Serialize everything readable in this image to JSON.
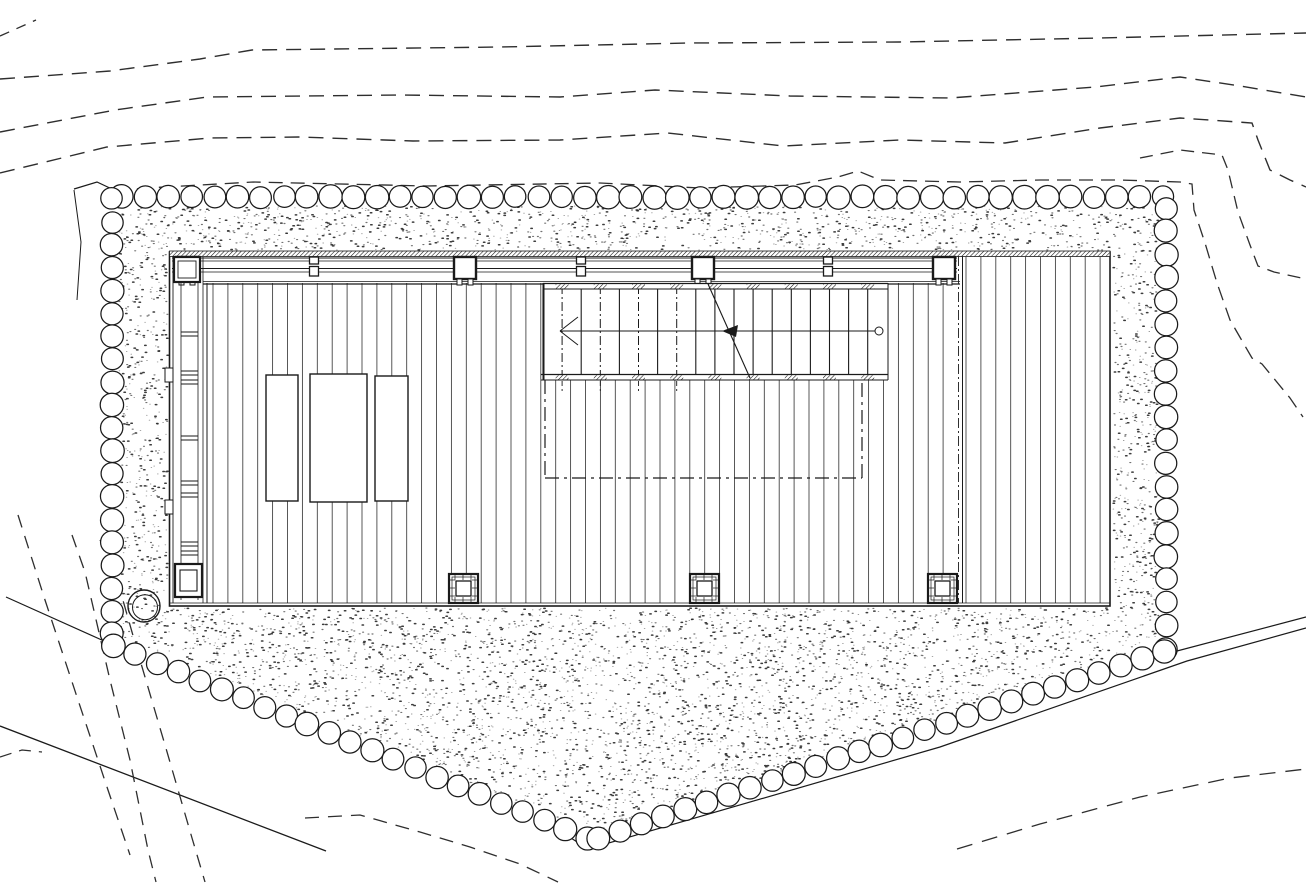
{
  "canvas": {
    "width": 1306,
    "height": 889,
    "background": "#ffffff"
  },
  "palette": {
    "ink": "#1a1a1a",
    "plank": "#3a3a3a",
    "dash": "#2e2e2e",
    "dot": "#1b1b1b"
  },
  "site": {
    "contour_lines_dashed": [
      {
        "name": "contour-top-corner",
        "dash": "10 8",
        "width": 1.3,
        "points": [
          [
            0,
            36
          ],
          [
            36,
            20
          ]
        ]
      },
      {
        "name": "contour-1",
        "dash": "15 9",
        "width": 1.4,
        "points": [
          [
            0,
            79
          ],
          [
            110,
            71
          ],
          [
            200,
            59
          ],
          [
            252,
            50
          ],
          [
            500,
            47
          ],
          [
            690,
            43
          ],
          [
            900,
            42
          ],
          [
            1100,
            38
          ],
          [
            1306,
            33
          ]
        ]
      },
      {
        "name": "contour-2",
        "dash": "15 9",
        "width": 1.4,
        "points": [
          [
            0,
            132
          ],
          [
            115,
            110
          ],
          [
            207,
            97
          ],
          [
            400,
            95
          ],
          [
            560,
            97
          ],
          [
            655,
            90
          ],
          [
            790,
            96
          ],
          [
            950,
            98
          ],
          [
            1095,
            87
          ],
          [
            1180,
            77
          ],
          [
            1240,
            86
          ],
          [
            1306,
            97
          ]
        ]
      },
      {
        "name": "contour-3",
        "dash": "15 9",
        "width": 1.4,
        "points": [
          [
            0,
            173
          ],
          [
            107,
            147
          ],
          [
            210,
            138
          ],
          [
            300,
            137
          ],
          [
            413,
            141
          ],
          [
            560,
            140
          ],
          [
            668,
            133
          ],
          [
            783,
            146
          ],
          [
            900,
            140
          ],
          [
            1005,
            143
          ],
          [
            1100,
            128
          ],
          [
            1180,
            118
          ],
          [
            1252,
            123
          ],
          [
            1258,
            140
          ],
          [
            1270,
            170
          ],
          [
            1290,
            180
          ],
          [
            1306,
            187
          ]
        ]
      },
      {
        "name": "contour-4-gravel-edge",
        "dash": "14 8",
        "width": 1.3,
        "points": [
          [
            115,
            191
          ],
          [
            147,
            188
          ],
          [
            253,
            182
          ],
          [
            427,
            186
          ],
          [
            600,
            183
          ],
          [
            700,
            188
          ],
          [
            795,
            185
          ],
          [
            838,
            177
          ],
          [
            858,
            171
          ],
          [
            880,
            180
          ],
          [
            960,
            182
          ],
          [
            1040,
            180
          ],
          [
            1120,
            180
          ],
          [
            1180,
            182
          ],
          [
            1192,
            184
          ],
          [
            1194,
            210
          ],
          [
            1205,
            243
          ],
          [
            1217,
            283
          ],
          [
            1230,
            320
          ],
          [
            1252,
            358
          ],
          [
            1262,
            364
          ],
          [
            1290,
            398
          ],
          [
            1303,
            417
          ]
        ]
      },
      {
        "name": "contour-5-right-slope",
        "dash": "13 8",
        "width": 1.3,
        "points": [
          [
            1140,
            158
          ],
          [
            1180,
            150
          ],
          [
            1222,
            155
          ],
          [
            1228,
            170
          ],
          [
            1238,
            212
          ],
          [
            1250,
            245
          ],
          [
            1258,
            266
          ],
          [
            1274,
            272
          ],
          [
            1306,
            279
          ]
        ]
      },
      {
        "name": "contour-steep-1",
        "dash": "13 9",
        "width": 1.3,
        "points": [
          [
            18,
            515
          ],
          [
            45,
            600
          ],
          [
            78,
            700
          ],
          [
            108,
            790
          ],
          [
            130,
            855
          ]
        ]
      },
      {
        "name": "contour-steep-2",
        "dash": "13 9",
        "width": 1.3,
        "points": [
          [
            72,
            535
          ],
          [
            85,
            572
          ],
          [
            110,
            680
          ],
          [
            130,
            760
          ],
          [
            148,
            850
          ],
          [
            156,
            882
          ]
        ]
      },
      {
        "name": "contour-steep-3",
        "dash": "13 9",
        "width": 1.3,
        "points": [
          [
            100,
            540
          ],
          [
            112,
            562
          ],
          [
            140,
            660
          ],
          [
            165,
            745
          ],
          [
            192,
            838
          ],
          [
            205,
            882
          ]
        ]
      },
      {
        "name": "contour-left-stub",
        "dash": "12 8",
        "width": 1.2,
        "points": [
          [
            0,
            757
          ],
          [
            22,
            750
          ],
          [
            42,
            752
          ]
        ]
      },
      {
        "name": "contour-bottom-arc",
        "dash": "14 9",
        "width": 1.3,
        "points": [
          [
            305,
            818
          ],
          [
            360,
            815
          ],
          [
            420,
            832
          ],
          [
            470,
            847
          ],
          [
            520,
            864
          ],
          [
            558,
            882
          ]
        ]
      },
      {
        "name": "contour-bottom-right",
        "dash": "16 10",
        "width": 1.3,
        "points": [
          [
            957,
            849
          ],
          [
            1040,
            824
          ],
          [
            1140,
            797
          ],
          [
            1230,
            778
          ],
          [
            1306,
            769
          ]
        ]
      }
    ],
    "boundary_lines_solid": [
      {
        "name": "site-line-upper-left",
        "width": 1.2,
        "points": [
          [
            6,
            597
          ],
          [
            104,
            641
          ]
        ]
      },
      {
        "name": "site-line-lower-left",
        "width": 1.3,
        "points": [
          [
            0,
            726
          ],
          [
            326,
            851
          ]
        ]
      },
      {
        "name": "site-line-lower-right",
        "width": 1.2,
        "points": [
          [
            557,
            829
          ],
          [
            588,
            849
          ],
          [
            940,
            747
          ],
          [
            1187,
            661
          ],
          [
            1306,
            628
          ]
        ]
      },
      {
        "name": "site-line-far-right",
        "width": 1.2,
        "points": [
          [
            1158,
            656
          ],
          [
            1306,
            617
          ]
        ]
      },
      {
        "name": "gravel-corner-top-left",
        "width": 1.2,
        "points": [
          [
            74,
            189
          ],
          [
            97,
            182
          ],
          [
            114,
            190
          ]
        ]
      },
      {
        "name": "gravel-corner-descender",
        "width": 1.0,
        "points": [
          [
            74,
            190
          ],
          [
            81,
            242
          ],
          [
            77,
            300
          ]
        ]
      }
    ],
    "stone_border": {
      "radius": 11.2,
      "spacing": 23,
      "stroke_width": 1.25,
      "runs": [
        {
          "name": "stones-top",
          "points": [
            [
              122,
              197
            ],
            [
              1163,
              197
            ]
          ]
        },
        {
          "name": "stones-left",
          "points": [
            [
              112,
              199
            ],
            [
              112,
              634
            ]
          ]
        },
        {
          "name": "stones-right",
          "points": [
            [
              1166,
              208
            ],
            [
              1166,
              649
            ]
          ]
        },
        {
          "name": "stones-bottom-left",
          "points": [
            [
              114,
              646
            ],
            [
              587,
              838
            ]
          ]
        },
        {
          "name": "stones-bottom-right",
          "points": [
            [
              598,
              838
            ],
            [
              1164,
              651
            ]
          ]
        }
      ]
    },
    "gravel_area": {
      "stipple_polygon": [
        [
          116,
          206
        ],
        [
          1160,
          206
        ],
        [
          1160,
          647
        ],
        [
          590,
          834
        ],
        [
          116,
          634
        ]
      ],
      "stipple": {
        "seed": 42,
        "tries": 20000
      }
    },
    "well": {
      "cx": 144,
      "cy": 606,
      "r_outer": 16,
      "r_inner": 12.5
    }
  },
  "building": {
    "deck": {
      "x": 169.5,
      "y": 252,
      "width": 940.5,
      "height": 354,
      "wall_hatch_height": 5.5,
      "bottom_inner_line_y": 603,
      "section_solid_x": 962.5,
      "section_divider_x": 958.5
    },
    "beam": {
      "x1": 172,
      "x2": 957,
      "line_ys": [
        258,
        261,
        268.5,
        272
      ],
      "deck_edge_ys": [
        281.5,
        284
      ],
      "deck_edge_x1": 203,
      "deck_edge_x2": 960
    },
    "columns_large": {
      "y": 257,
      "size": 22,
      "centers_x": [
        187,
        465,
        703,
        944
      ]
    },
    "columns_small": {
      "centers_x": [
        314,
        581,
        828
      ]
    },
    "left_channel": {
      "wall_x": 173,
      "rail_x1": 181,
      "rail_x2": 198,
      "edge_x": 203,
      "deck_edge_x": 207,
      "rungs_y": [
        [
          277,
          281
        ],
        [
          332,
          336
        ],
        [
          371,
          375
        ],
        [
          380,
          384
        ],
        [
          436,
          440
        ],
        [
          481,
          485
        ],
        [
          493,
          497
        ],
        [
          542,
          546
        ],
        [
          551,
          555
        ],
        [
          576,
          580
        ]
      ],
      "tabs": [
        [
          165,
          368
        ],
        [
          165,
          500
        ]
      ],
      "top_plate": {
        "x": 174,
        "y": 257,
        "w": 26,
        "h": 25
      },
      "bottom_plate": {
        "x": 175,
        "y": 564,
        "w": 27,
        "h": 33
      }
    },
    "planks": {
      "main_x1": 213,
      "main_x2": 957,
      "spacing": 14.9,
      "top_y": 283,
      "bottom_y": 603,
      "stair_clip": [
        545,
        888
      ],
      "stair_bottom_y": 380,
      "right_x1": 966,
      "right_x2": 1108,
      "right_top_y": 256
    },
    "furniture_rects": [
      [
        266,
        375,
        32,
        126
      ],
      [
        310,
        374,
        57,
        128
      ],
      [
        375,
        376,
        33,
        125
      ]
    ],
    "stair": {
      "x1": 543,
      "x2": 888,
      "band_top_y": 283.5,
      "band_h": 5.5,
      "band_bottom_y": 374.5,
      "tread_spacing": 19.1,
      "tread_count": 18,
      "dashdot_limit_x": 713,
      "walk_line": {
        "y": 331,
        "x1": 560,
        "x2": 877,
        "end_circle_r": 4,
        "mid_arrow_x": 738
      },
      "break_line": [
        [
          708,
          284
        ],
        [
          750,
          378
        ]
      ]
    },
    "subfloor_outline_dashed": {
      "x1": 545,
      "x2": 862,
      "y1": 380,
      "y2": 478,
      "dash": "14 5 3 5"
    },
    "base_plates": {
      "size": 29,
      "positions": [
        [
          449,
          574
        ],
        [
          690,
          574
        ],
        [
          928,
          574
        ]
      ]
    }
  }
}
